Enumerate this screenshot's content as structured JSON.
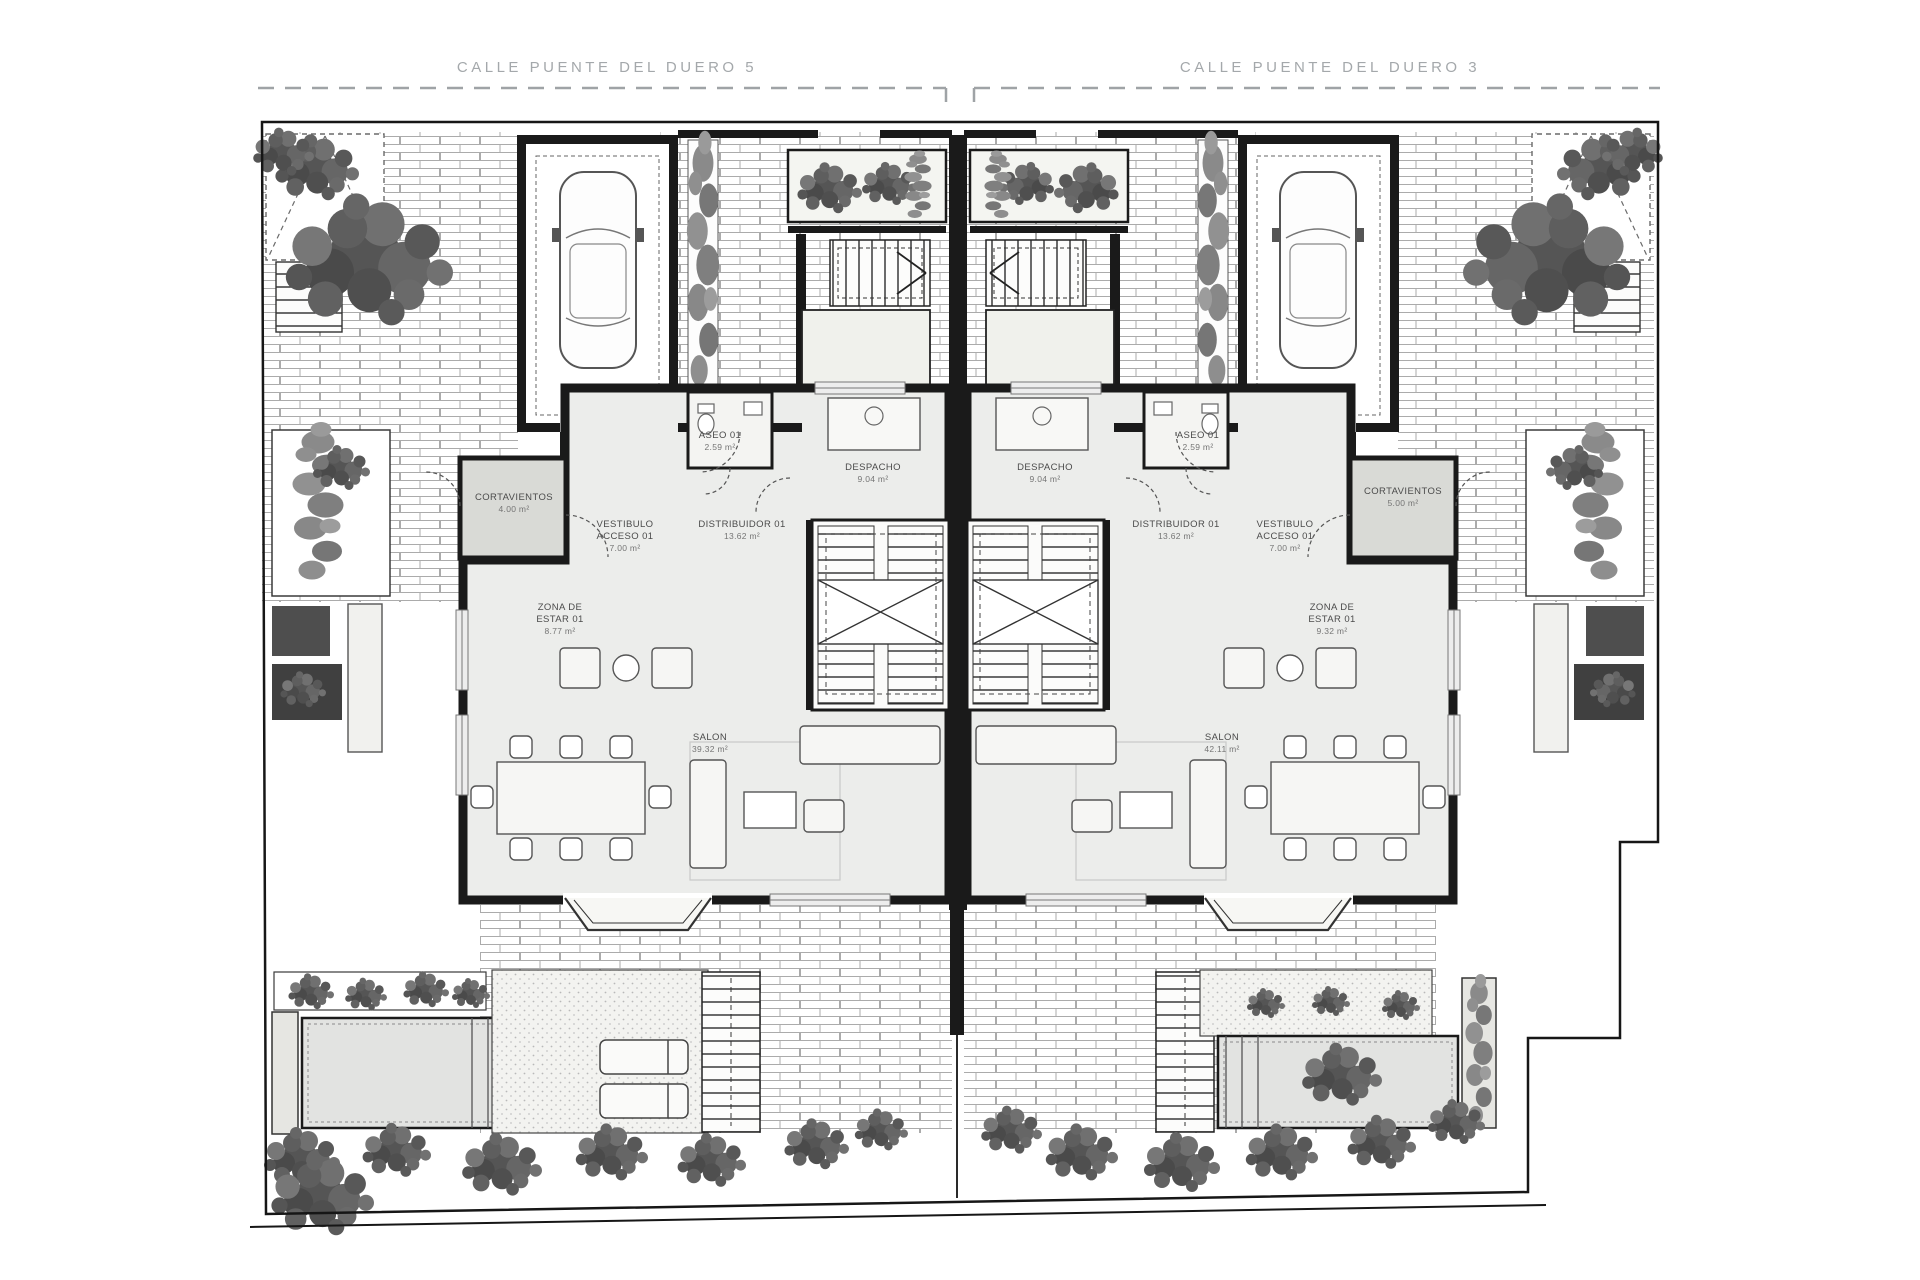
{
  "plan": {
    "title": "Ground floor plan - two semi-detached houses",
    "street_left": "CALLE PUENTE DEL DUERO 5",
    "street_right": "CALLE PUENTE DEL DUERO 3",
    "colors": {
      "wall": "#1a1a1a",
      "room_fill": "#ecedeb",
      "paving_line": "#ababab",
      "vegetation": "#585858",
      "label": "#4b4b4b",
      "street_label": "#a4a8ab",
      "pool_fill": "#e2e3e1"
    },
    "unit_left": {
      "cortavientos": {
        "l1": "CORTAVIENTOS",
        "l2": "",
        "area": "4.00 m²"
      },
      "vestibulo": {
        "l1": "VESTIBULO",
        "l2": "ACCESO 01",
        "area": "7.00 m²"
      },
      "aseo": {
        "l1": "ASEO 01",
        "l2": "",
        "area": "2.59 m²"
      },
      "despacho": {
        "l1": "DESPACHO",
        "l2": "",
        "area": "9.04 m²"
      },
      "distribuidor": {
        "l1": "DISTRIBUIDOR 01",
        "l2": "",
        "area": "13.62 m²"
      },
      "zona_estar": {
        "l1": "ZONA DE",
        "l2": "ESTAR 01",
        "area": "8.77 m²"
      },
      "salon": {
        "l1": "SALON",
        "l2": "",
        "area": "39.32 m²"
      }
    },
    "unit_right": {
      "cortavientos": {
        "l1": "CORTAVIENTOS",
        "l2": "",
        "area": "5.00 m²"
      },
      "vestibulo": {
        "l1": "VESTIBULO",
        "l2": "ACCESO 01",
        "area": "7.00 m²"
      },
      "aseo": {
        "l1": "ASEO 01",
        "l2": "",
        "area": "2.59 m²"
      },
      "despacho": {
        "l1": "DESPACHO",
        "l2": "",
        "area": "9.04 m²"
      },
      "distribuidor": {
        "l1": "DISTRIBUIDOR 01",
        "l2": "",
        "area": "13.62 m²"
      },
      "zona_estar": {
        "l1": "ZONA DE",
        "l2": "ESTAR 01",
        "area": "9.32 m²"
      },
      "salon": {
        "l1": "SALON",
        "l2": "",
        "area": "42.11 m²"
      }
    }
  }
}
